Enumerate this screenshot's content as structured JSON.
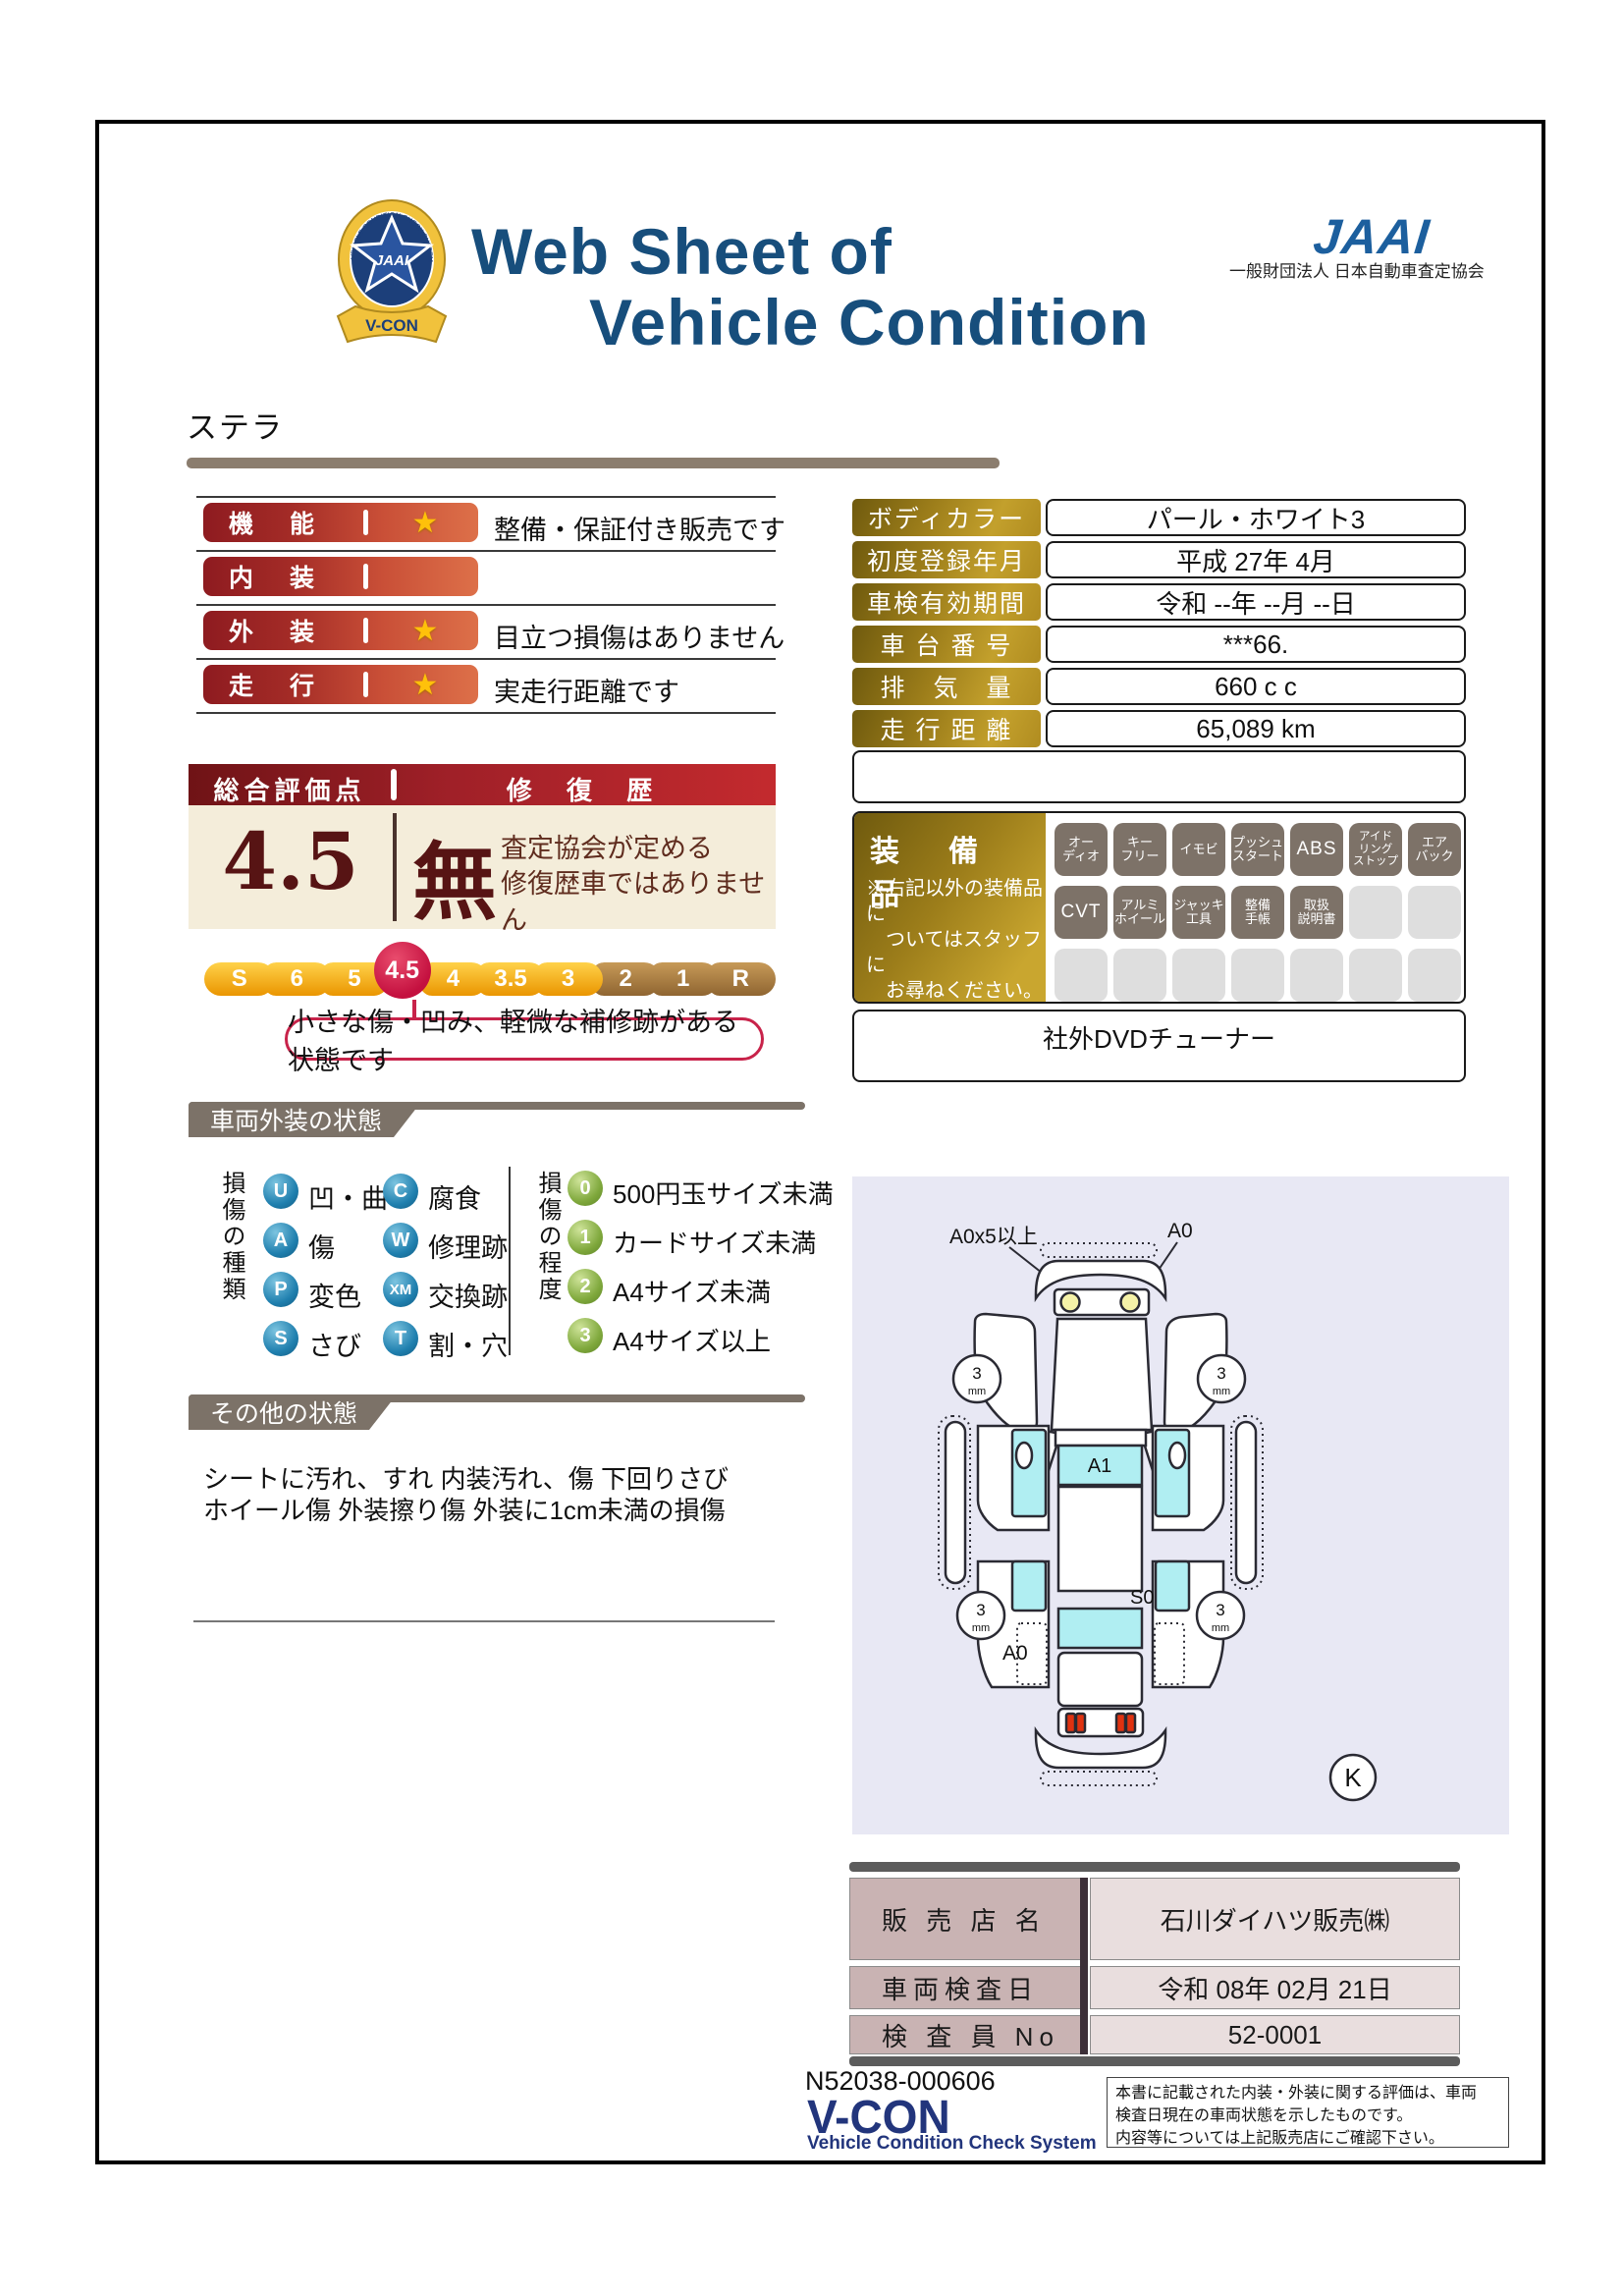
{
  "header": {
    "title_line1": "Web Sheet of",
    "title_line2": "Vehicle Condition",
    "jaai_logo_text": "JAAI",
    "jaai_org": "一般財団法人 日本自動車査定協会",
    "badge_jaai": "JAAI",
    "badge_vcon": "V-CON",
    "badge_ring_text": "VEHICLE CONDITION CHECK SYSTEM"
  },
  "vehicle_name": "ステラ",
  "icons": {
    "star": "★"
  },
  "ratings": {
    "rows": [
      {
        "label": "機　能",
        "comment": "整備・保証付き販売です"
      },
      {
        "label": "内　装",
        "comment": ""
      },
      {
        "label": "外　装",
        "comment": "目立つ損傷はありません"
      },
      {
        "label": "走　行",
        "comment": "実走行距離です"
      }
    ]
  },
  "overall": {
    "header_left": "総合評価点",
    "header_right": "修 復 歴",
    "score": "4.5",
    "repair": "無",
    "repair_note": "査定協会が定める\n修復歴車ではありません"
  },
  "scale": {
    "items": [
      "S",
      "6",
      "5",
      "4.5",
      "4",
      "3.5",
      "3",
      "2",
      "1",
      "R"
    ],
    "selected": "4.5",
    "callout": "小さな傷・凹み、軽微な補修跡がある状態です"
  },
  "sections": {
    "exterior": "車両外装の状態",
    "other": "その他の状態"
  },
  "damage_types": {
    "axis_label": "損傷の種類",
    "items": [
      {
        "code": "U",
        "label": "凹・曲"
      },
      {
        "code": "C",
        "label": "腐食"
      },
      {
        "code": "A",
        "label": "傷"
      },
      {
        "code": "W",
        "label": "修理跡"
      },
      {
        "code": "P",
        "label": "変色"
      },
      {
        "code": "XM",
        "label": "交換跡"
      },
      {
        "code": "S",
        "label": "さび"
      },
      {
        "code": "T",
        "label": "割・穴"
      }
    ]
  },
  "damage_degrees": {
    "axis_label": "損傷の程度",
    "items": [
      {
        "code": "0",
        "label": "500円玉サイズ未満"
      },
      {
        "code": "1",
        "label": "カードサイズ未満"
      },
      {
        "code": "2",
        "label": "A4サイズ未満"
      },
      {
        "code": "3",
        "label": "A4サイズ以上"
      }
    ]
  },
  "other_condition": {
    "line1": "シートに汚れ、すれ 内装汚れ、傷 下回りさび",
    "line2": "ホイール傷 外装擦り傷 外装に1cm未満の損傷"
  },
  "vehicle_info": {
    "rows": [
      {
        "label": "ボディカラー",
        "value": "パール・ホワイト3"
      },
      {
        "label": "初度登録年月",
        "value": "平成 27年 4月"
      },
      {
        "label": "車検有効期間",
        "value": "令和 --年 --月 --日"
      },
      {
        "label": "車 台 番 号",
        "value": "***66."
      },
      {
        "label": "排　気　量",
        "value": "660 c c"
      },
      {
        "label": "走 行 距 離",
        "value": "65,089 km"
      }
    ]
  },
  "equipment": {
    "title": "装　備　品",
    "note": "※右記以外の装備品に\n　ついてはスタッフに\n　お尋ねください。",
    "badges": [
      "オー\nディオ",
      "キー\nフリー",
      "イモビ",
      "プッシュ\nスタート",
      "ABS",
      "アイド\nリング\nストップ",
      "エア\nバック",
      "CVT",
      "アルミ\nホイール",
      "ジャッキ\n工具",
      "整備\n手帳",
      "取扱\n説明書"
    ],
    "extra_note": "社外DVDチューナー"
  },
  "diagram": {
    "label_top_left": "A0x5以上",
    "label_top_right": "A0",
    "label_windshield": "A1",
    "label_roof": "S0",
    "label_rear_left": "A0",
    "wheel_value": "3",
    "wheel_unit": "mm",
    "key_mark": "K"
  },
  "store": {
    "rows": [
      {
        "label": "販 売 店 名",
        "value": "石川ダイハツ販売㈱"
      },
      {
        "label": "車両検査日",
        "value": "令和 08年 02月 21日"
      },
      {
        "label": "検 査 員 No",
        "value": "52-0001"
      }
    ]
  },
  "footer": {
    "doc_number": "N52038-000606",
    "vcon_logo": "V-CON",
    "vcon_sub": "Vehicle Condition Check System",
    "note": "本書に記載された内装・外装に関する評価は、車両\n検査日現在の車両状態を示したものです。\n内容等については上記販売店にご確認下さい。"
  }
}
